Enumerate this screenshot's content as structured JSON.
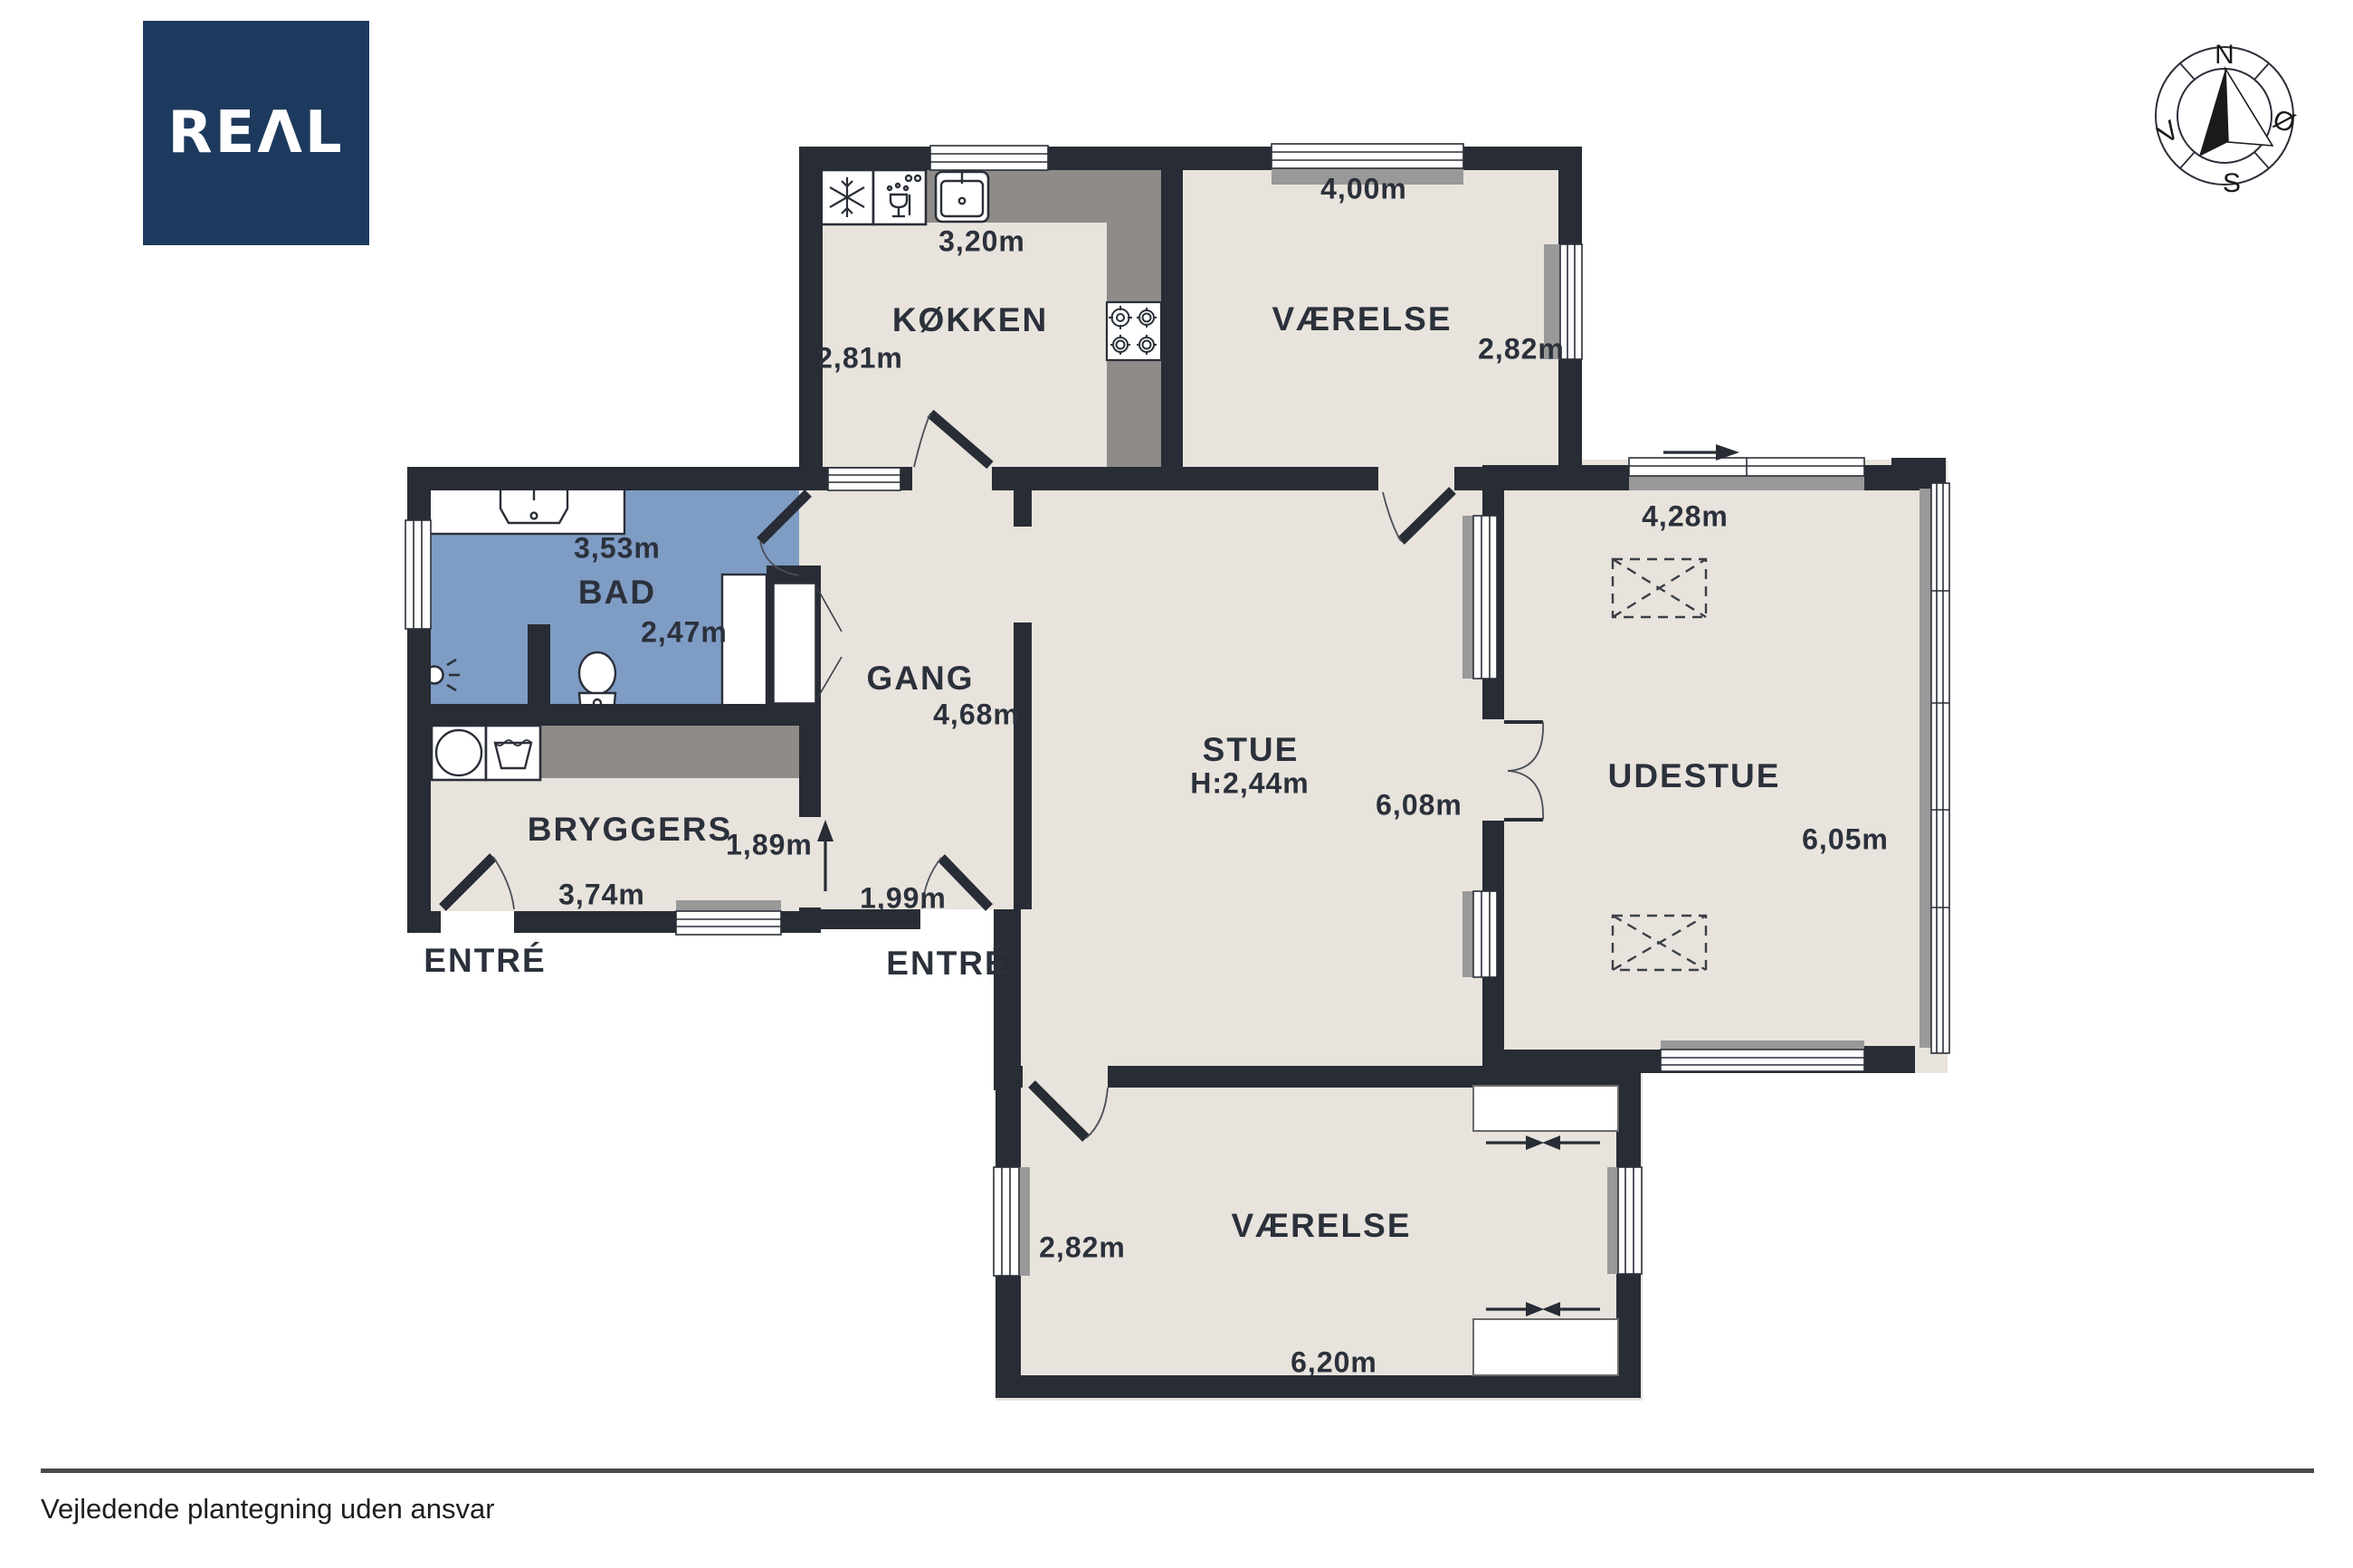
{
  "branding": {
    "logo": "REΛL"
  },
  "compass": {
    "north": "N",
    "east": "Ø",
    "south": "S",
    "west": "V"
  },
  "rooms": {
    "kokken": {
      "name": "KØKKEN",
      "width": "3,20m",
      "depth": "2,81m"
    },
    "vaerelse_top": {
      "name": "VÆRELSE",
      "width": "4,00m",
      "depth": "2,82m"
    },
    "bad": {
      "name": "BAD",
      "width": "3,53m",
      "depth": "2,47m"
    },
    "gang": {
      "name": "GANG",
      "length": "4,68m",
      "entry_width": "1,99m"
    },
    "stue": {
      "name": "STUE",
      "ceiling_height": "H:2,44m",
      "width": "6,08m"
    },
    "udestue": {
      "name": "UDESTUE",
      "width": "4,28m",
      "depth": "6,05m"
    },
    "bryggers": {
      "name": "BRYGGERS",
      "width": "3,74m",
      "opening_width": "1,89m"
    },
    "vaerelse_bottom": {
      "name": "VÆRELSE",
      "width": "6,20m",
      "depth": "2,82m"
    },
    "entre_left": {
      "name": "ENTRÉ"
    },
    "entre_right": {
      "name": "ENTRÉ"
    }
  },
  "footer": {
    "disclaimer": "Vejledende plantegning uden ansvar"
  },
  "colors": {
    "wall": "#272c35",
    "floor": "#e8e3dc",
    "bathroom": "#7f9cc5",
    "counter": "#8e8b88",
    "sill": "#999999",
    "logo_bg": "#1d3a5e"
  }
}
